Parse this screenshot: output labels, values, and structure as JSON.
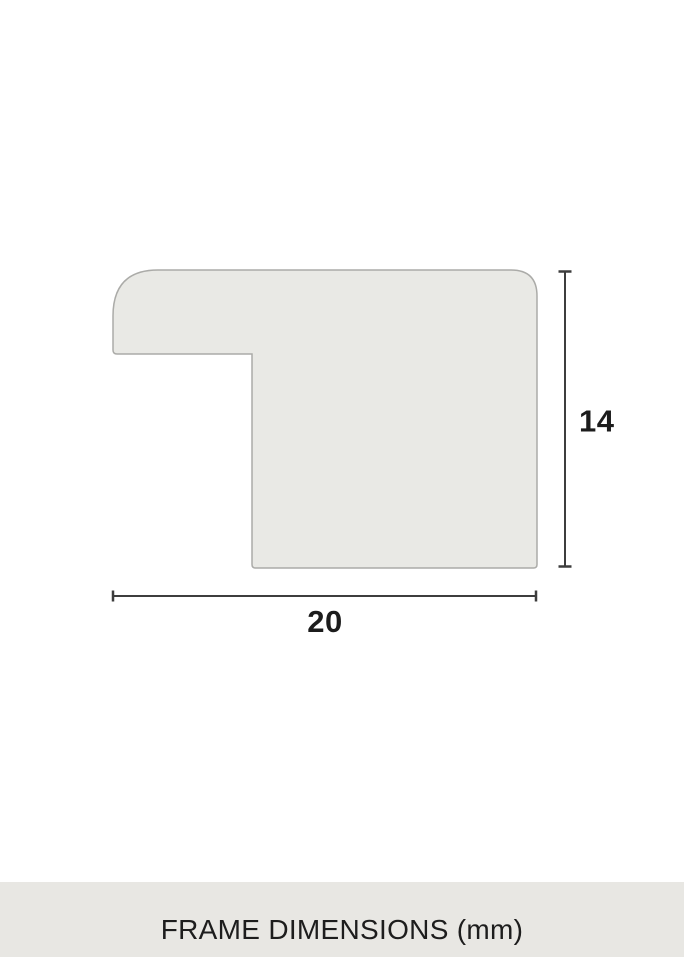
{
  "diagram": {
    "height_label": "14",
    "width_label": "20",
    "colors": {
      "shape_fill": "#e9e9e5",
      "shape_stroke": "#ababa8",
      "dimension_line": "#3d3d3d",
      "label_text": "#1c1c1c"
    }
  },
  "footer": {
    "title": "FRAME DIMENSIONS (mm)",
    "background": "#e8e7e3",
    "text_color": "#1d1d1d"
  }
}
